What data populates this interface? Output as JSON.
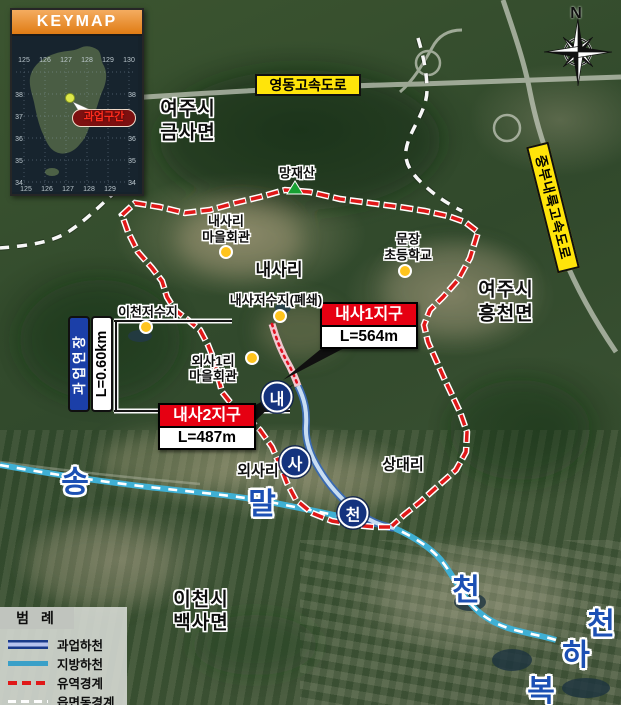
{
  "keymap": {
    "title": "KEYMAP",
    "marker_label": "과업구간",
    "grid": {
      "top": [
        "125",
        "126",
        "127",
        "128",
        "129",
        "130"
      ],
      "left": [
        "38",
        "37",
        "36",
        "35",
        "34"
      ],
      "right": [
        "38",
        "37",
        "36",
        "35",
        "34"
      ],
      "bottom": [
        "125",
        "126",
        "127",
        "128",
        "129"
      ]
    }
  },
  "compass": {
    "north": "N"
  },
  "expressways": {
    "yeongdong": "영동고속도로",
    "jungbu_naeryuk": "중부내륙고속도로"
  },
  "districts": [
    {
      "title": "내사1지구",
      "length": "L=564m"
    },
    {
      "title": "내사2지구",
      "length": "L=487m"
    }
  ],
  "extent": {
    "label": "과업연장",
    "length": "L=0.60km"
  },
  "places": {
    "yeoju_geumsa": [
      "여주시",
      "금사면"
    ],
    "mangjaesan": "망재산",
    "naesari_hall": [
      "내사리",
      "마을회관"
    ],
    "naesari": "내사리",
    "munjang_school": [
      "문장",
      "초등학교"
    ],
    "yeoju_heungcheon": [
      "여주시",
      "흥천면"
    ],
    "naesa_reservoir": "내사저수지(폐쇄)",
    "icheon_reservoir": "이천저수지",
    "oesa1ri_hall": [
      "외사1리",
      "마을회관"
    ],
    "oesari": "외사리",
    "sangdaeri": "상대리",
    "icheon_baeksa": [
      "이천시",
      "백사면"
    ]
  },
  "streams": {
    "naesacheon": [
      "내",
      "사",
      "천"
    ],
    "songmalcheon": [
      "송",
      "말",
      "천"
    ],
    "bokhacheon": [
      "복",
      "하",
      "천"
    ]
  },
  "legend": {
    "title": "범 례",
    "items": [
      {
        "label": "과업하천"
      },
      {
        "label": "지방하천"
      },
      {
        "label": "유역경계"
      },
      {
        "label": "읍면동경계"
      }
    ]
  },
  "colors": {
    "district_red": "#e60012",
    "expressway_yellow": "#ffe40a",
    "extent_blue": "#1b3fa8",
    "watershed_red": "#e01818",
    "local_stream_cyan": "#3fb0d4",
    "project_stream_blue": "#3a6ab0",
    "marker_yellow": "#ffc41e",
    "river_text_blue": "#1c50b4",
    "stream_circle_navy": "#14337e"
  }
}
